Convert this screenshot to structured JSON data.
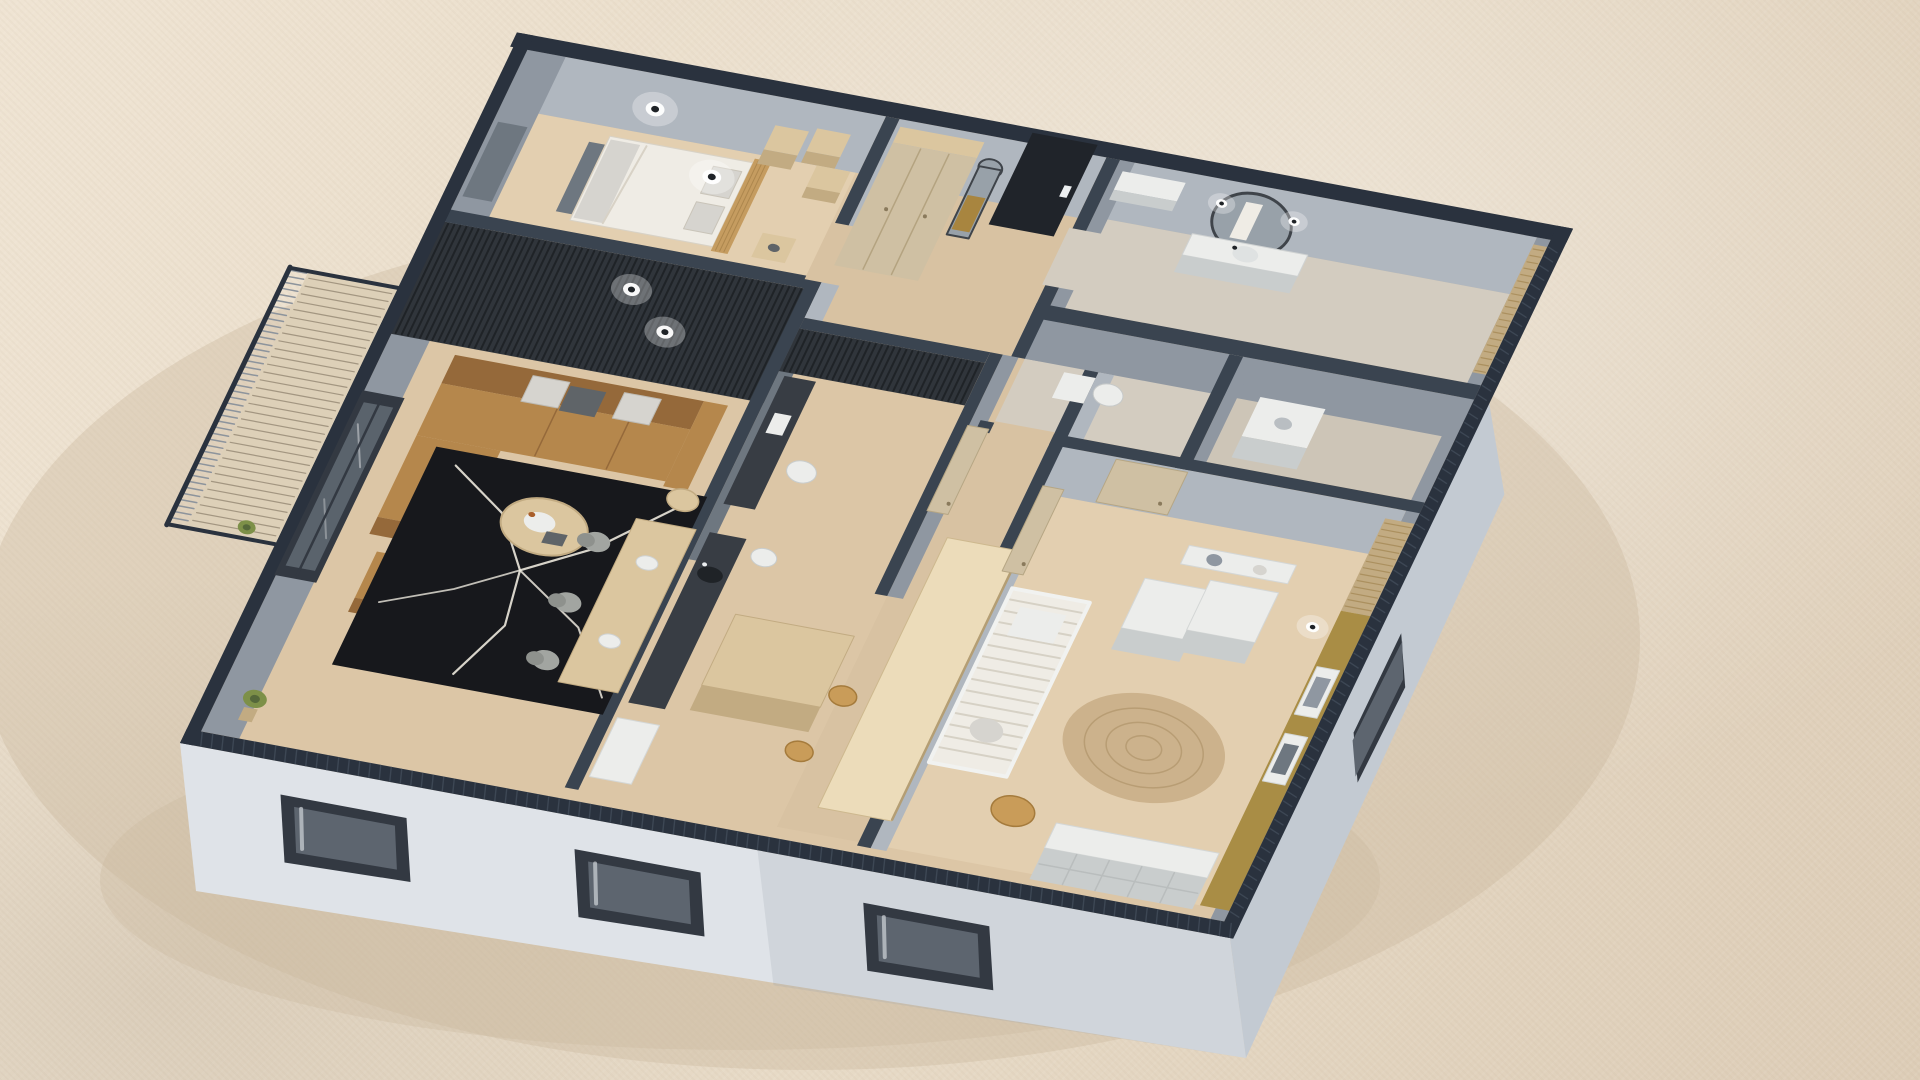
{
  "meta": {
    "title": "Apartment 3D floor plan render",
    "view": "axonometric dollhouse cutaway",
    "canvas": {
      "width": 1920,
      "height": 1080
    }
  },
  "palette": {
    "bg": "none",
    "shadow": "#cbb99e",
    "facade": "#dfe3e8",
    "facade_shade": "#c3cad2",
    "window_dark": "#333942",
    "window_glass": "#5d656f",
    "curtain": "#d9dde1",
    "wall_top": "#2a323e",
    "wall_top2": "#3a4450",
    "wall_face": "#b0b7bf",
    "wall_face_dark": "#8f97a1",
    "wall_face_deep": "#6e7780",
    "slat_dark": "#30353b",
    "slat_line": "#1f2327",
    "floor_wood": "#dcc6a6",
    "floor_warm": "#e3cfb0",
    "floor_hall": "#d8c2a2",
    "floor_bath": "#d3ccc0",
    "floor_gray": "#cdc5b7",
    "wood_light": "#dbc69f",
    "wood_mid": "#c2ab82",
    "wood_bright": "#ecdcba",
    "door_wood": "#cfc0a3",
    "door_black": "#20242a",
    "handle": "#eceff1",
    "brass": "#a8853f",
    "mirror_ring": "#3f444a",
    "mirror_glass": "#98a1a9",
    "sofa": "#b5874c",
    "sofa_dark": "#95693a",
    "pillow_light": "#d6d4cf",
    "pillow_dark": "#5f6468",
    "rug_black": "#17181c",
    "rug_vein": "#ece8dd",
    "chair_gray": "#a2a5a1",
    "chair_oak": "#c99c59",
    "oak_dark": "#a57b3c",
    "bed_white": "#efece5",
    "headboard": "#c59c60",
    "crib_white": "#f1f2f0",
    "white_furn": "#ecedeb",
    "white_furn_shade": "#c9cdcd",
    "counter_dark": "#383d44",
    "olive": "#a98d45",
    "jute": "#ccb28c",
    "jute_line": "#b89d74",
    "plant": "#7d9048",
    "plant_dark": "#55683a",
    "glow": "#ffffff",
    "cup": "#a95f2b",
    "rail_line": "#8d949c",
    "balcony_floor": "#ddd0b8",
    "balcony_line": "#a39681"
  },
  "scene": {
    "rooms": [
      {
        "id": "bedroom",
        "furniture": [
          "double-bed",
          "tan-headboard",
          "nightstands",
          "pendant-bulbs",
          "wall-cubes"
        ]
      },
      {
        "id": "entry-hall",
        "furniture": [
          "wardrobe",
          "arch-mirror",
          "black-entry-door"
        ]
      },
      {
        "id": "bathroom",
        "furniture": [
          "round-mirror",
          "vanity",
          "sconces",
          "wood-slat-accent"
        ]
      },
      {
        "id": "wc-laundry",
        "furniture": [
          "toilet",
          "washing-machine"
        ]
      },
      {
        "id": "living-room",
        "furniture": [
          "camel-sectional-sofa",
          "black-veined-rug",
          "round-coffee-table",
          "dining-table",
          "gray-chairs",
          "balcony-window",
          "round-wall-lights",
          "plant"
        ]
      },
      {
        "id": "study",
        "furniture": [
          "dark-desk",
          "white-chair",
          "slat-screen"
        ]
      },
      {
        "id": "kitchen",
        "furniture": [
          "dark-counter-with-sink",
          "wood-island",
          "white-cabinet",
          "oak-chairs",
          "tall-light-cabinet"
        ]
      },
      {
        "id": "nursery",
        "furniture": [
          "crib",
          "round-jute-rug",
          "white-dressers",
          "floating-shelf-with-toys",
          "olive-accent-wall",
          "picture-frames",
          "cube-bookshelf",
          "mustard-pouf"
        ]
      }
    ],
    "exterior": [
      "stucco-ground",
      "white-facade-with-windows",
      "balcony-with-railing",
      "dark-wall-tops"
    ]
  }
}
